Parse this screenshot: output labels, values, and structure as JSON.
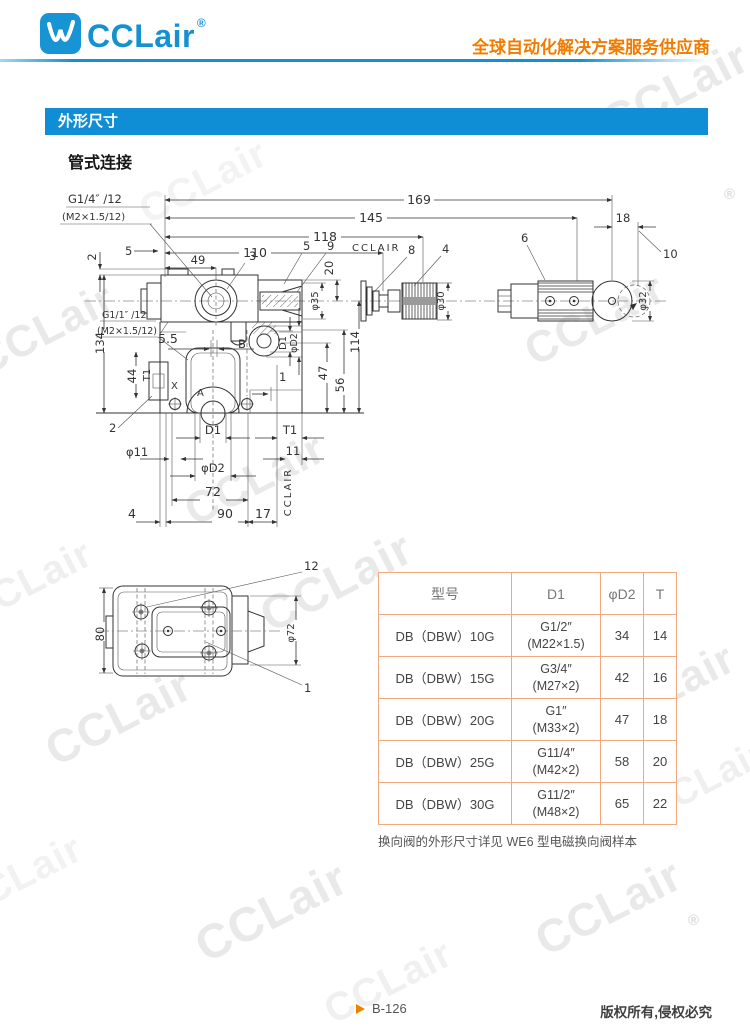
{
  "header": {
    "logo_text": "CCLair",
    "logo_reg": "®",
    "tagline": "全球自动化解决方案服务供应商"
  },
  "section_banner": "外形尺寸",
  "subtitle": "管式连接",
  "drawing": {
    "labels": {
      "g14a": "G1/4″ /12",
      "g14b": "(M2×1.5/12)",
      "d5": "5",
      "d2": "2",
      "d169": "169",
      "d145": "145",
      "d118": "118",
      "d110": "110",
      "d49": "49",
      "n3": "3",
      "n5": "5",
      "n9": "9",
      "cctop": "CCLAIR",
      "n8": "8",
      "n4": "4",
      "n6": "6",
      "d18": "18",
      "n10": "10",
      "d20": "20",
      "p35": "φ35",
      "p30": "φ30",
      "p32": "φ32",
      "d114": "114",
      "g11a": "G1/1″ /12",
      "g11b": "(M2×1.5/12)",
      "d134": "134",
      "d55": "5.5",
      "d44": "44",
      "t1l": "T1",
      "pb": "B",
      "d1v": "D1",
      "pd2v": "φD2",
      "d47": "47",
      "d56": "56",
      "n2": "2",
      "px": "X",
      "pa": "A",
      "n1": "1",
      "p11": "φ11",
      "d1b": "D1",
      "t1b": "T1",
      "d11": "11",
      "pd2b": "φD2",
      "d72": "72",
      "d4": "4",
      "d90": "90",
      "d17": "17",
      "ccv": "CCLAIR",
      "n12": "12",
      "d80": "80",
      "p72": "φ72",
      "n1b": "1"
    }
  },
  "table": {
    "headers": [
      "型号",
      "D1",
      "φD2",
      "T"
    ],
    "rows": [
      {
        "model": "DB（DBW）10G",
        "d1_line1": "G1/2″",
        "d1_line2": "(M22×1.5)",
        "d2": "34",
        "t": "14"
      },
      {
        "model": "DB（DBW）15G",
        "d1_line1": "G3/4″",
        "d1_line2": "(M27×2)",
        "d2": "42",
        "t": "16"
      },
      {
        "model": "DB（DBW）20G",
        "d1_line1": "G1″",
        "d1_line2": "(M33×2)",
        "d2": "47",
        "t": "18"
      },
      {
        "model": "DB（DBW）25G",
        "d1_line1": "G11/4″",
        "d1_line2": "(M42×2)",
        "d2": "58",
        "t": "20"
      },
      {
        "model": "DB（DBW）30G",
        "d1_line1": "G11/2″",
        "d1_line2": "(M48×2)",
        "d2": "65",
        "t": "22"
      }
    ]
  },
  "note": "换向阀的外形尺寸详见 WE6 型电磁换向阀样本",
  "footer": {
    "page": "B-126",
    "copyright": "版权所有,侵权必究"
  },
  "watermark": {
    "text": "CCLair",
    "reg": "®"
  },
  "colors": {
    "brand_blue": "#1590d0",
    "banner_blue": "#0f8ed6",
    "tagline_orange": "#f07c00",
    "table_border": "#f2a97e",
    "page_marker_orange": "#f08200"
  }
}
